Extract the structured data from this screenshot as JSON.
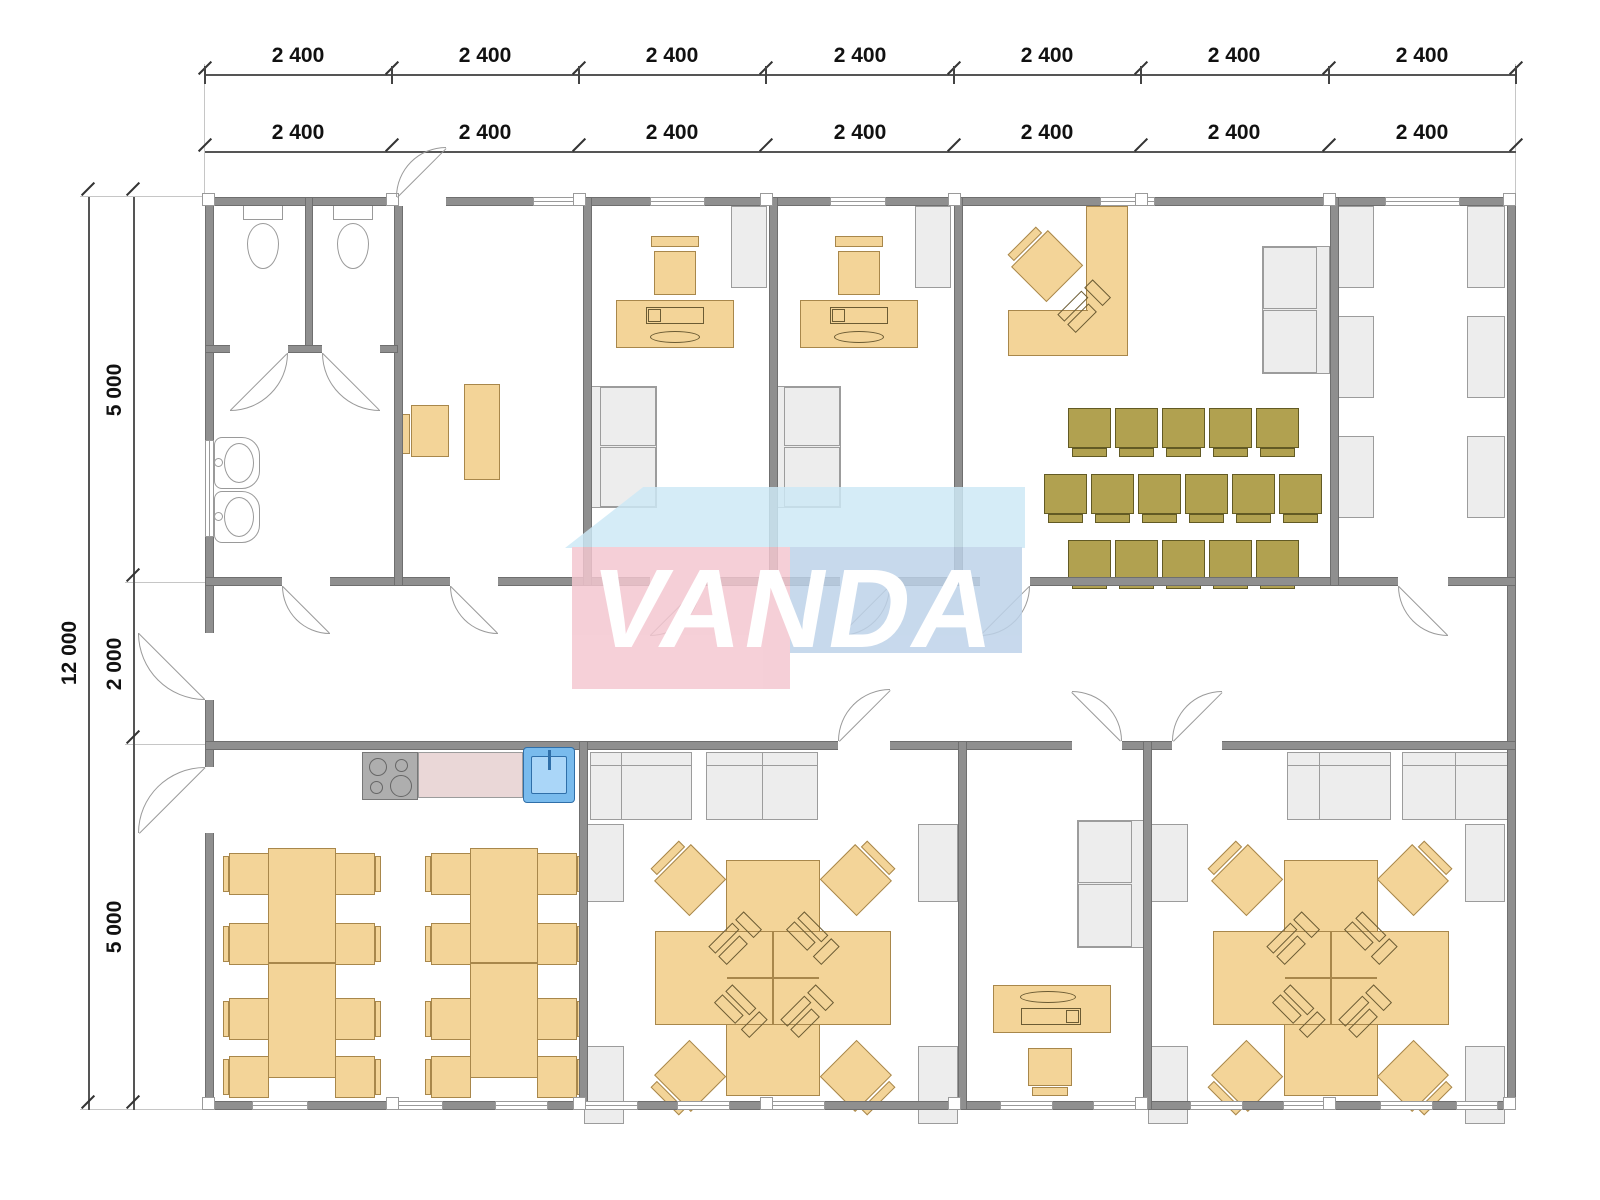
{
  "watermark": {
    "text": "VANDA"
  },
  "dimensions": {
    "top_row1": [
      "2 400",
      "2 400",
      "2 400",
      "2 400",
      "2 400",
      "2 400",
      "2 400"
    ],
    "top_row2": [
      "2 400",
      "2 400",
      "2 400",
      "2 400",
      "2 400",
      "2 400",
      "2 400"
    ],
    "left_total": "12 000",
    "left_segments": [
      "5 000",
      "2 000",
      "5 000"
    ]
  },
  "colors": {
    "wall": "#8f8f8f",
    "wallEdge": "#6f6f6f",
    "line": "#9a9a9a",
    "tan": "#f3d498",
    "tanBorder": "#a8874b",
    "olive": "#b1a150",
    "oliveBorder": "#625a24",
    "grayFill": "#ededed",
    "grayBorder": "#9c9c9c",
    "glyph": "#6b5b33",
    "stove": "#aeaeae",
    "counter": "#ead7d7",
    "sinkBlue": "#79bbed",
    "sinkBlueDark": "#2f6fa9",
    "sinkInner": "#aad6f8",
    "wmPink": "#f4c7d0",
    "wmBlue": "#bdd2e9",
    "wmTop": "#cdе9f6"
  }
}
